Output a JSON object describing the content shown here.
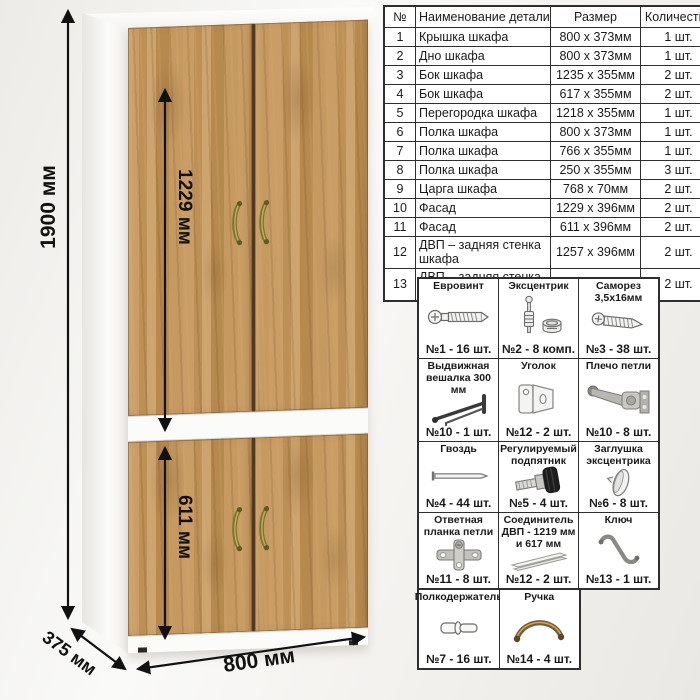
{
  "dimensions": {
    "height": "1900 мм",
    "facade_upper": "1229 мм",
    "facade_lower": "611 мм",
    "width": "800 мм",
    "depth": "375 мм"
  },
  "parts_table": {
    "headers": [
      "№",
      "Наименование детали",
      "Размер",
      "Количество"
    ],
    "rows": [
      [
        "1",
        "Крышка шкафа",
        "800 x 373мм",
        "1 шт."
      ],
      [
        "2",
        "Дно шкафа",
        "800 x 373мм",
        "1 шт."
      ],
      [
        "3",
        "Бок шкафа",
        "1235 x 355мм",
        "2 шт."
      ],
      [
        "4",
        "Бок шкафа",
        "617 x 355мм",
        "2 шт."
      ],
      [
        "5",
        "Перегородка шкафа",
        "1218 x 355мм",
        "1 шт."
      ],
      [
        "6",
        "Полка шкафа",
        "800 x 373мм",
        "1 шт."
      ],
      [
        "7",
        "Полка шкафа",
        "766 x 355мм",
        "1 шт."
      ],
      [
        "8",
        "Полка шкафа",
        "250 x 355мм",
        "3 шт."
      ],
      [
        "9",
        "Царга шкафа",
        "768 x 70мм",
        "2 шт."
      ],
      [
        "10",
        "Фасад",
        "1229 x 396мм",
        "2 шт."
      ],
      [
        "11",
        "Фасад",
        "611 x 396мм",
        "2 шт."
      ],
      [
        "12",
        "ДВП – задняя стенка шкафа",
        "1257 x 396мм",
        "2 шт."
      ],
      [
        "13",
        "ДВП – задняя стенка шкафа",
        "639 x 396мм",
        "2 шт."
      ]
    ]
  },
  "hardware": {
    "items": [
      {
        "title": "Евровинт",
        "count": "№1 - 16 шт.",
        "icon": "euro-screw-icon"
      },
      {
        "title": "Эксцентрик",
        "count": "№2 - 8 комп.",
        "icon": "cam-lock-icon"
      },
      {
        "title": "Саморез 3,5x16мм",
        "count": "№3 - 38 шт.",
        "icon": "self-tapping-screw-icon"
      },
      {
        "title": "Выдвижная вешалка 300 мм",
        "count": "№10 - 1 шт.",
        "icon": "pull-out-hanger-icon"
      },
      {
        "title": "Уголок",
        "count": "№12 - 2 шт.",
        "icon": "corner-bracket-icon"
      },
      {
        "title": "Плечо петли",
        "count": "№10 - 8 шт.",
        "icon": "hinge-arm-icon"
      },
      {
        "title": "Гвоздь",
        "count": "№4 - 44 шт.",
        "icon": "nail-icon"
      },
      {
        "title": "Регулируемый подпятник",
        "count": "№5 - 4 шт.",
        "icon": "adjustable-foot-icon"
      },
      {
        "title": "Заглушка эксцентрика",
        "count": "№6 - 8 шт.",
        "icon": "cam-cap-icon"
      },
      {
        "title": "Ответная планка петли",
        "count": "№11 - 8 шт.",
        "icon": "hinge-plate-icon"
      },
      {
        "title": "Соединитель ДВП - 1219 мм и 617 мм",
        "count": "№12 - 2 шт.",
        "icon": "hdf-connector-icon"
      },
      {
        "title": "Ключ",
        "count": "№13 - 1 шт.",
        "icon": "hex-key-icon"
      },
      {
        "title": "Полкодержатель",
        "count": "№7 - 16 шт.",
        "icon": "shelf-pin-icon"
      },
      {
        "title": "Ручка",
        "count": "№14 - 4 шт.",
        "icon": "door-handle-icon"
      }
    ]
  },
  "colors": {
    "wood": "#c2955e",
    "carcass_white": "#fbfbfa",
    "handle_bronze": "#857b2f",
    "line": "#111111"
  }
}
